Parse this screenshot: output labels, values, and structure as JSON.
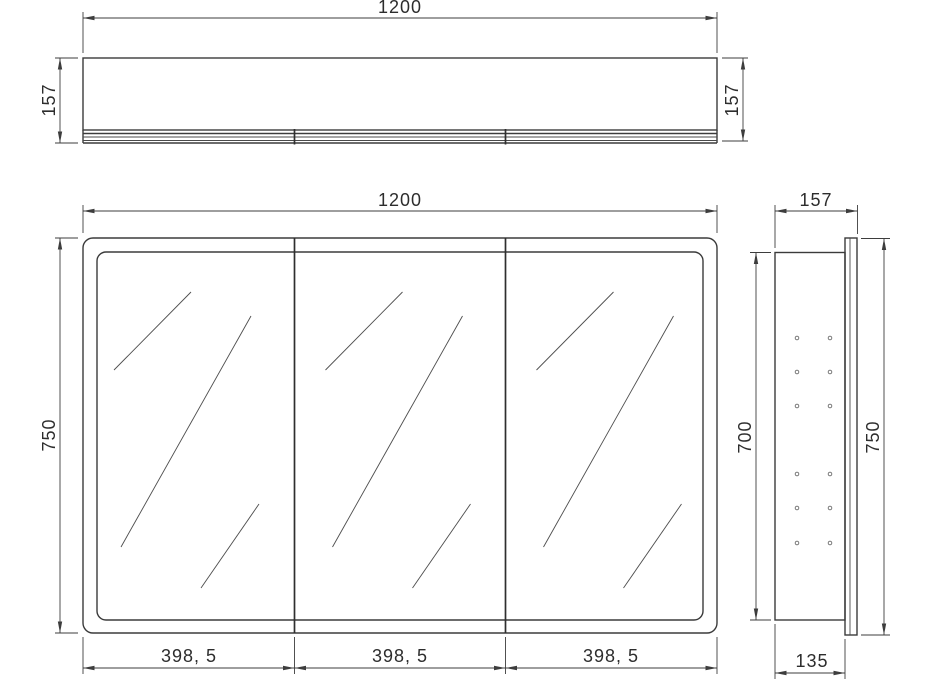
{
  "drawing": {
    "type": "technical-drawing-3-view",
    "subject": "mirror cabinet",
    "colors": {
      "background": "#ffffff",
      "object_line": "#3b3b3b",
      "dimension_line": "#3d3d3d"
    },
    "views": {
      "top": {
        "dim_width": "1200",
        "dim_depth_left": "157",
        "dim_depth_right": "157"
      },
      "front": {
        "dim_width": "1200",
        "dim_height": "750",
        "dim_doors": [
          "398, 5",
          "398, 5",
          "398, 5"
        ]
      },
      "side": {
        "dim_depth": "157",
        "dim_inner_height": "700",
        "dim_outer_height": "750",
        "dim_bottom_depth": "135"
      }
    }
  }
}
